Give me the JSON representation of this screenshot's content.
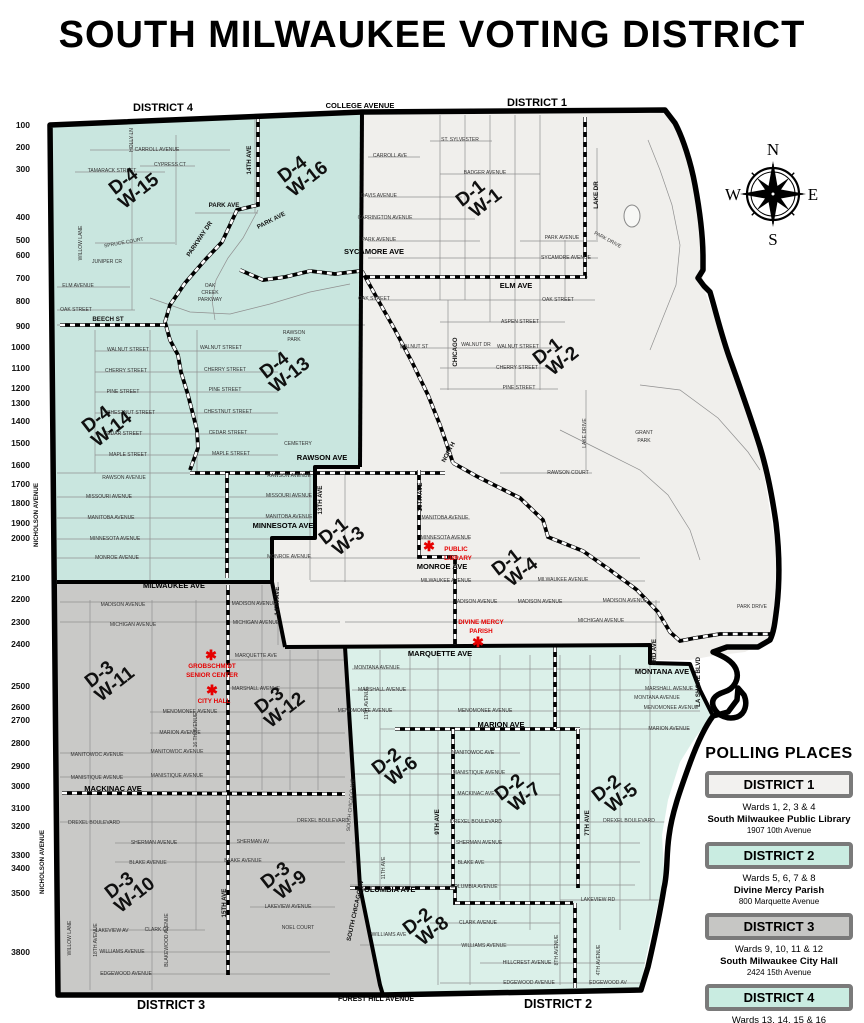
{
  "title": "SOUTH MILWAUKEE VOTING DISTRICT",
  "edge_labels": [
    {
      "text": "DISTRICT 4",
      "x": 163,
      "y": 111,
      "size": 11
    },
    {
      "text": "COLLEGE AVENUE",
      "x": 360,
      "y": 108,
      "size": 7.5
    },
    {
      "text": "DISTRICT 1",
      "x": 537,
      "y": 106,
      "size": 11
    },
    {
      "text": "DISTRICT 3",
      "x": 171,
      "y": 1009,
      "size": 12.5
    },
    {
      "text": "FOREST HILL AVENUE",
      "x": 376,
      "y": 1001,
      "size": 7
    },
    {
      "text": "DISTRICT 2",
      "x": 558,
      "y": 1008,
      "size": 12.5
    }
  ],
  "compass": {
    "north": "N",
    "east": "E",
    "south": "S",
    "west": "W"
  },
  "districts": [
    {
      "id": "d4",
      "name": "District 4",
      "color": "#c9e6df"
    },
    {
      "id": "d1",
      "name": "District 1",
      "color": "#f0efec"
    },
    {
      "id": "d3",
      "name": "District 3",
      "color": "#c9c9c7"
    },
    {
      "id": "d2",
      "name": "District 2",
      "color": "#dbf0e9"
    }
  ],
  "scale_labels": [
    {
      "v": "100",
      "y": 125
    },
    {
      "v": "200",
      "y": 147
    },
    {
      "v": "300",
      "y": 169
    },
    {
      "v": "400",
      "y": 217
    },
    {
      "v": "500",
      "y": 240
    },
    {
      "v": "600",
      "y": 255
    },
    {
      "v": "700",
      "y": 278
    },
    {
      "v": "800",
      "y": 301
    },
    {
      "v": "900",
      "y": 326
    },
    {
      "v": "1000",
      "y": 347
    },
    {
      "v": "1100",
      "y": 368
    },
    {
      "v": "1200",
      "y": 388
    },
    {
      "v": "1300",
      "y": 403
    },
    {
      "v": "1400",
      "y": 421
    },
    {
      "v": "1500",
      "y": 443
    },
    {
      "v": "1600",
      "y": 465
    },
    {
      "v": "1700",
      "y": 484
    },
    {
      "v": "1800",
      "y": 503
    },
    {
      "v": "1900",
      "y": 523
    },
    {
      "v": "2000",
      "y": 538
    },
    {
      "v": "2100",
      "y": 578
    },
    {
      "v": "2200",
      "y": 599
    },
    {
      "v": "2300",
      "y": 622
    },
    {
      "v": "2400",
      "y": 644
    },
    {
      "v": "2500",
      "y": 686
    },
    {
      "v": "2600",
      "y": 707
    },
    {
      "v": "2700",
      "y": 720
    },
    {
      "v": "2800",
      "y": 743
    },
    {
      "v": "2900",
      "y": 766
    },
    {
      "v": "3000",
      "y": 786
    },
    {
      "v": "3100",
      "y": 808
    },
    {
      "v": "3200",
      "y": 826
    },
    {
      "v": "3300",
      "y": 855
    },
    {
      "v": "3400",
      "y": 868
    },
    {
      "v": "3500",
      "y": 893
    },
    {
      "v": "3800",
      "y": 952
    }
  ],
  "ward_labels": [
    {
      "d": "D-4",
      "w": "W-15",
      "x": 127,
      "y": 186
    },
    {
      "d": "D-4",
      "w": "W-16",
      "x": 296,
      "y": 174
    },
    {
      "d": "D-4",
      "w": "W-13",
      "x": 278,
      "y": 370
    },
    {
      "d": "D-4",
      "w": "W-14",
      "x": 100,
      "y": 424
    },
    {
      "d": "D-1",
      "w": "W-1",
      "x": 474,
      "y": 198
    },
    {
      "d": "D-1",
      "w": "W-2",
      "x": 551,
      "y": 356
    },
    {
      "d": "D-1",
      "w": "W-3",
      "x": 337,
      "y": 536
    },
    {
      "d": "D-1",
      "w": "W-4",
      "x": 510,
      "y": 567
    },
    {
      "d": "D-3",
      "w": "W-11",
      "x": 103,
      "y": 679
    },
    {
      "d": "D-3",
      "w": "W-12",
      "x": 273,
      "y": 705
    },
    {
      "d": "D-3",
      "w": "W-10",
      "x": 123,
      "y": 890
    },
    {
      "d": "D-3",
      "w": "W-9",
      "x": 279,
      "y": 880
    },
    {
      "d": "D-2",
      "w": "W-6",
      "x": 390,
      "y": 766
    },
    {
      "d": "D-2",
      "w": "W-7",
      "x": 513,
      "y": 792
    },
    {
      "d": "D-2",
      "w": "W-5",
      "x": 610,
      "y": 793
    },
    {
      "d": "D-2",
      "w": "W-8",
      "x": 421,
      "y": 926
    }
  ],
  "pois": [
    {
      "name": "public-library",
      "star": [
        429,
        546
      ],
      "lines": [
        {
          "t": "PUBLIC",
          "x": 456,
          "y": 551
        },
        {
          "t": "LIBRARY",
          "x": 458,
          "y": 560
        }
      ]
    },
    {
      "name": "divine-mercy-parish",
      "star": [
        478,
        642
      ],
      "lines": [
        {
          "t": "DIVINE MERCY",
          "x": 481,
          "y": 624
        },
        {
          "t": "PARISH",
          "x": 481,
          "y": 633
        }
      ]
    },
    {
      "name": "grobschmidt-senior-center",
      "star": [
        211,
        655
      ],
      "lines": [
        {
          "t": "GROBSCHMIDT",
          "x": 212,
          "y": 668
        },
        {
          "t": "SENIOR CENTER",
          "x": 212,
          "y": 677
        }
      ]
    },
    {
      "name": "city-hall",
      "star": [
        212,
        690
      ],
      "lines": [
        {
          "t": "CITY HALL",
          "x": 214,
          "y": 703
        }
      ]
    }
  ],
  "street_labels": [
    {
      "t": "CARROLL  AVENUE",
      "x": 157,
      "y": 151
    },
    {
      "t": "CYPRESS CT",
      "x": 170,
      "y": 166
    },
    {
      "t": "TAMARACK STREET",
      "x": 112,
      "y": 172
    },
    {
      "t": "HOLLY LN",
      "x": 133,
      "y": 140,
      "r": -90
    },
    {
      "t": "PARK AVE",
      "x": 224,
      "y": 207,
      "k": "s"
    },
    {
      "t": "PARK AVE",
      "x": 272,
      "y": 222,
      "r": -27,
      "k": "s"
    },
    {
      "t": "PARKWAY DR",
      "x": 201,
      "y": 240,
      "r": -56,
      "k": "s"
    },
    {
      "t": "14TH AVE",
      "x": 251,
      "y": 160,
      "r": -90,
      "k": "s"
    },
    {
      "t": "OAK",
      "x": 210,
      "y": 287
    },
    {
      "t": "CREEK",
      "x": 210,
      "y": 294
    },
    {
      "t": "PARKWAY",
      "x": 210,
      "y": 301
    },
    {
      "t": "ELM  AVENUE",
      "x": 78,
      "y": 287
    },
    {
      "t": "OAK  STREET",
      "x": 76,
      "y": 311
    },
    {
      "t": "BEECH ST",
      "x": 108,
      "y": 321,
      "k": "s"
    },
    {
      "t": "SPRUCE  COURT",
      "x": 124,
      "y": 244,
      "r": -10
    },
    {
      "t": "JUNIPER CR",
      "x": 107,
      "y": 263
    },
    {
      "t": "WILLOW  LANE",
      "x": 82,
      "y": 243,
      "r": -90
    },
    {
      "t": "WALNUT  STREET",
      "x": 128,
      "y": 351
    },
    {
      "t": "WALNUT  STREET",
      "x": 221,
      "y": 349
    },
    {
      "t": "CHERRY  STREET",
      "x": 126,
      "y": 372
    },
    {
      "t": "CHERRY  STREET",
      "x": 225,
      "y": 371
    },
    {
      "t": "PINE  STREET",
      "x": 123,
      "y": 393
    },
    {
      "t": "PINE  STREET",
      "x": 225,
      "y": 391
    },
    {
      "t": "CHESTNUT  STREET",
      "x": 131,
      "y": 414
    },
    {
      "t": "CHESTNUT  STREET",
      "x": 228,
      "y": 413
    },
    {
      "t": "CEDAR  STREET",
      "x": 123,
      "y": 435
    },
    {
      "t": "CEDAR  STREET",
      "x": 228,
      "y": 434
    },
    {
      "t": "MAPLE  STREET",
      "x": 128,
      "y": 456
    },
    {
      "t": "MAPLE  STREET",
      "x": 231,
      "y": 455
    },
    {
      "t": "RAWSON AVE",
      "x": 322,
      "y": 460,
      "k": "b"
    },
    {
      "t": "RAWSON",
      "x": 294,
      "y": 334
    },
    {
      "t": "PARK",
      "x": 294,
      "y": 341
    },
    {
      "t": "CEMETERY",
      "x": 298,
      "y": 445
    },
    {
      "t": "RAWSON  AVENUE",
      "x": 124,
      "y": 479
    },
    {
      "t": "RAWSON  AVENUE",
      "x": 289,
      "y": 477
    },
    {
      "t": "MISSOURI AVENUE",
      "x": 109,
      "y": 498
    },
    {
      "t": "MISSOURI AVENUE",
      "x": 289,
      "y": 497
    },
    {
      "t": "MANITOBA AVENUE",
      "x": 111,
      "y": 519
    },
    {
      "t": "MANITOBA AVENUE",
      "x": 289,
      "y": 518
    },
    {
      "t": "MINNESOTA AVENUE",
      "x": 115,
      "y": 540
    },
    {
      "t": "MINNESOTA AVE",
      "x": 283,
      "y": 528,
      "k": "b"
    },
    {
      "t": "MONROE AVENUE",
      "x": 117,
      "y": 559
    },
    {
      "t": "MONROE  AVENUE",
      "x": 289,
      "y": 558
    },
    {
      "t": "13TH AVE",
      "x": 322,
      "y": 500,
      "r": -90,
      "k": "s"
    },
    {
      "t": "NICHOLSON AVENUE",
      "x": 38,
      "y": 515,
      "r": -90,
      "k": "s"
    },
    {
      "t": "NICHOLSON AVENUE",
      "x": 44,
      "y": 862,
      "r": -90,
      "k": "s"
    },
    {
      "t": "ST. SYLVESTER",
      "x": 460,
      "y": 141
    },
    {
      "t": "CARROLL AVE",
      "x": 390,
      "y": 157
    },
    {
      "t": "BADGER  AVENUE",
      "x": 485,
      "y": 174
    },
    {
      "t": "DAVIS  AVENUE",
      "x": 379,
      "y": 197
    },
    {
      "t": "CARRINGTON  AVENUE",
      "x": 385,
      "y": 219
    },
    {
      "t": "PARK  AVENUE",
      "x": 379,
      "y": 241
    },
    {
      "t": "PARK  AVENUE",
      "x": 562,
      "y": 239
    },
    {
      "t": "SYCAMORE AVE",
      "x": 374,
      "y": 254,
      "k": "b"
    },
    {
      "t": "SYCAMORE  AVENUE",
      "x": 566,
      "y": 259
    },
    {
      "t": "ELM AVE",
      "x": 516,
      "y": 288,
      "k": "b"
    },
    {
      "t": "OAK  STREET",
      "x": 374,
      "y": 300
    },
    {
      "t": "OAK  STREET",
      "x": 558,
      "y": 301
    },
    {
      "t": "ASPEN  STREET",
      "x": 520,
      "y": 323
    },
    {
      "t": "WALNUT ST",
      "x": 414,
      "y": 348
    },
    {
      "t": "WALNUT DR",
      "x": 476,
      "y": 346
    },
    {
      "t": "WALNUT STREET",
      "x": 518,
      "y": 348
    },
    {
      "t": "CHERRY STREET",
      "x": 517,
      "y": 369
    },
    {
      "t": "PINE  STREET",
      "x": 519,
      "y": 389
    },
    {
      "t": "CHICAGO",
      "x": 457,
      "y": 352,
      "r": -90,
      "k": "s"
    },
    {
      "t": "NORTH",
      "x": 450,
      "y": 453,
      "r": -62,
      "k": "s"
    },
    {
      "t": "LAKE DR",
      "x": 598,
      "y": 195,
      "r": -90,
      "k": "s"
    },
    {
      "t": "LAKE  DRIVE",
      "x": 586,
      "y": 433,
      "r": -90
    },
    {
      "t": "RAWSON COURT",
      "x": 568,
      "y": 474
    },
    {
      "t": "GRANT",
      "x": 644,
      "y": 434
    },
    {
      "t": "PARK",
      "x": 644,
      "y": 442
    },
    {
      "t": "PARK DRIVE",
      "x": 607,
      "y": 241,
      "r": 28
    },
    {
      "t": "PARK DRIVE",
      "x": 752,
      "y": 608
    },
    {
      "t": "10TH AVE",
      "x": 422,
      "y": 497,
      "r": -90,
      "k": "s"
    },
    {
      "t": "MANITOBA AVENUE",
      "x": 445,
      "y": 519
    },
    {
      "t": "MINNESOTA AVENUE",
      "x": 446,
      "y": 539
    },
    {
      "t": "MONROE AVE",
      "x": 442,
      "y": 569,
      "k": "b"
    },
    {
      "t": "MILWAUKEE AVENUE",
      "x": 446,
      "y": 582
    },
    {
      "t": "MILWAUKEE AVENUE",
      "x": 563,
      "y": 581
    },
    {
      "t": "MADISON AVENUE",
      "x": 475,
      "y": 603
    },
    {
      "t": "MADISON AVENUE",
      "x": 540,
      "y": 603
    },
    {
      "t": "MADISON AVENUE",
      "x": 625,
      "y": 602
    },
    {
      "t": "MICHIGAN AVENUE",
      "x": 601,
      "y": 622
    },
    {
      "t": "14TH AVE",
      "x": 279,
      "y": 601,
      "r": -90,
      "k": "s"
    },
    {
      "t": "3RD AVE",
      "x": 656,
      "y": 652,
      "r": -90,
      "k": "s"
    },
    {
      "t": "LA SHORE BLVD",
      "x": 700,
      "y": 682,
      "r": -90,
      "k": "s"
    },
    {
      "t": "MONTANA AVE",
      "x": 662,
      "y": 674,
      "k": "b"
    },
    {
      "t": "MILWAUKEE AVE",
      "x": 174,
      "y": 588,
      "k": "b"
    },
    {
      "t": "MADISON AVENUE",
      "x": 123,
      "y": 606
    },
    {
      "t": "MADISON AVENUE",
      "x": 254,
      "y": 605
    },
    {
      "t": "MICHIGAN AVENUE",
      "x": 133,
      "y": 626
    },
    {
      "t": "MICHIGAN AVENUE",
      "x": 256,
      "y": 624
    },
    {
      "t": "MARQUETTE AVE",
      "x": 256,
      "y": 657
    },
    {
      "t": "MARSHALL AVENUE",
      "x": 256,
      "y": 690
    },
    {
      "t": "MENOMONEE  AVENUE",
      "x": 190,
      "y": 713
    },
    {
      "t": "MARION  AVENUE",
      "x": 180,
      "y": 734
    },
    {
      "t": "MANITOWOC  AVENUE",
      "x": 97,
      "y": 756
    },
    {
      "t": "MANITOWOC AVENUE",
      "x": 177,
      "y": 753
    },
    {
      "t": "MANISTIQUE  AVENUE",
      "x": 97,
      "y": 779
    },
    {
      "t": "MANISTIQUE AVENUE",
      "x": 177,
      "y": 777
    },
    {
      "t": "MACKINAC AVE",
      "x": 113,
      "y": 791,
      "k": "b"
    },
    {
      "t": "DREXEL  BOULEVARD",
      "x": 94,
      "y": 824
    },
    {
      "t": "DREXEL BOULEVARD",
      "x": 323,
      "y": 822
    },
    {
      "t": "SHERMAN AVENUE",
      "x": 154,
      "y": 844
    },
    {
      "t": "SHERMAN  AV",
      "x": 253,
      "y": 843
    },
    {
      "t": "BLAKE AVENUE",
      "x": 148,
      "y": 864
    },
    {
      "t": "BLAKE  AVENUE",
      "x": 243,
      "y": 862
    },
    {
      "t": "LAKEVIEW AV",
      "x": 112,
      "y": 932
    },
    {
      "t": "LAKEVIEW  AVENUE",
      "x": 288,
      "y": 908
    },
    {
      "t": "WILLIAMS AVENUE",
      "x": 122,
      "y": 953
    },
    {
      "t": "EDGEWOOD  AVENUE",
      "x": 126,
      "y": 975
    },
    {
      "t": "CLARK CT",
      "x": 157,
      "y": 931
    },
    {
      "t": "NOEL COURT",
      "x": 298,
      "y": 929
    },
    {
      "t": "15TH AVE",
      "x": 226,
      "y": 903,
      "r": -90,
      "k": "s"
    },
    {
      "t": "16 TH AVENUE",
      "x": 197,
      "y": 730,
      "r": -90
    },
    {
      "t": "WILLOW LANE",
      "x": 71,
      "y": 938,
      "r": -90
    },
    {
      "t": "18TH AVENUE",
      "x": 97,
      "y": 940,
      "r": -90
    },
    {
      "t": "BLAKEWOOD AVENUE",
      "x": 168,
      "y": 940,
      "r": -90
    },
    {
      "t": "MARQUETTE AVE",
      "x": 440,
      "y": 656,
      "k": "b"
    },
    {
      "t": "MONTANA AVENUE",
      "x": 377,
      "y": 669
    },
    {
      "t": "MONTANA AVENUE",
      "x": 657,
      "y": 699
    },
    {
      "t": "MARSHALL AVENUE",
      "x": 382,
      "y": 691
    },
    {
      "t": "MARSHALL AVENUE",
      "x": 669,
      "y": 690
    },
    {
      "t": "MENOMONEE AVENUE",
      "x": 365,
      "y": 712
    },
    {
      "t": "MENOMONEE AVENUE",
      "x": 485,
      "y": 712
    },
    {
      "t": "MENOMONEE AVENUE",
      "x": 671,
      "y": 709
    },
    {
      "t": "MARION AVE",
      "x": 501,
      "y": 727,
      "k": "b"
    },
    {
      "t": "MARION AVENUE",
      "x": 669,
      "y": 730
    },
    {
      "t": "MANITOWOC AVE",
      "x": 473,
      "y": 754
    },
    {
      "t": "MANISTIQUE  AVENUE",
      "x": 479,
      "y": 774
    },
    {
      "t": "MACKINAC  AVE",
      "x": 476,
      "y": 795
    },
    {
      "t": "DREXEL  BOULEVARD",
      "x": 476,
      "y": 823
    },
    {
      "t": "DREXEL BOULEVARD",
      "x": 629,
      "y": 822
    },
    {
      "t": "SHERMAN  AVENUE",
      "x": 479,
      "y": 844
    },
    {
      "t": "BLAKE AVE",
      "x": 471,
      "y": 864
    },
    {
      "t": "COLUMBIA  AVENUE",
      "x": 474,
      "y": 888
    },
    {
      "t": "COLUMBIA AVE",
      "x": 387,
      "y": 892,
      "k": "b"
    },
    {
      "t": "CLARK  AVENUE",
      "x": 478,
      "y": 924
    },
    {
      "t": "WILLIAMS AVE",
      "x": 389,
      "y": 936
    },
    {
      "t": "WILLIAMS  AVENUE",
      "x": 484,
      "y": 947
    },
    {
      "t": "HILLCREST  AVENUE",
      "x": 527,
      "y": 964
    },
    {
      "t": "EDGEWOOD  AVENUE",
      "x": 529,
      "y": 984
    },
    {
      "t": "EDGEWOOD AV",
      "x": 608,
      "y": 984
    },
    {
      "t": "LAKEVIEW RD",
      "x": 598,
      "y": 901
    },
    {
      "t": "9TH AVE",
      "x": 439,
      "y": 822,
      "r": -90,
      "k": "s"
    },
    {
      "t": "7TH AVE",
      "x": 589,
      "y": 823,
      "r": -90,
      "k": "s"
    },
    {
      "t": "11TH AVE",
      "x": 385,
      "y": 868,
      "r": -90
    },
    {
      "t": "11TH AVENUE",
      "x": 368,
      "y": 703,
      "r": -90
    },
    {
      "t": "SOUTH CHICAGO AV",
      "x": 357,
      "y": 911,
      "r": -78,
      "k": "s"
    },
    {
      "t": "SOUTH CHICAGO AVE",
      "x": 352,
      "y": 805,
      "r": -85
    },
    {
      "t": "8TH AVENUE",
      "x": 558,
      "y": 950,
      "r": -90
    },
    {
      "t": "4TH  AVENUE",
      "x": 600,
      "y": 960,
      "r": -90
    }
  ],
  "legend": {
    "title": "POLLING PLACES",
    "entries": [
      {
        "district": "DISTRICT 1",
        "wards": "Wards 1, 2, 3 & 4",
        "place": "South Milwaukee Public Library",
        "address": "1907 10th Avenue",
        "fill": "#f2f1ef"
      },
      {
        "district": "DISTRICT 2",
        "wards": "Wards 5, 6, 7 & 8",
        "place": "Divine Mercy Parish",
        "address": "800 Marquette Avenue",
        "fill": "#c9ece1"
      },
      {
        "district": "DISTRICT 3",
        "wards": "Wards 9, 10, 11 & 12",
        "place": "South Milwaukee City Hall",
        "address": "2424 15th Avenue",
        "fill": "#c6c6c4"
      },
      {
        "district": "DISTRICT 4",
        "wards": "Wards 13, 14, 15 & 16",
        "place": "Grobschmidt Senior Center",
        "address": "2424 15th Avenue",
        "fill": "#c9ece1"
      }
    ]
  }
}
